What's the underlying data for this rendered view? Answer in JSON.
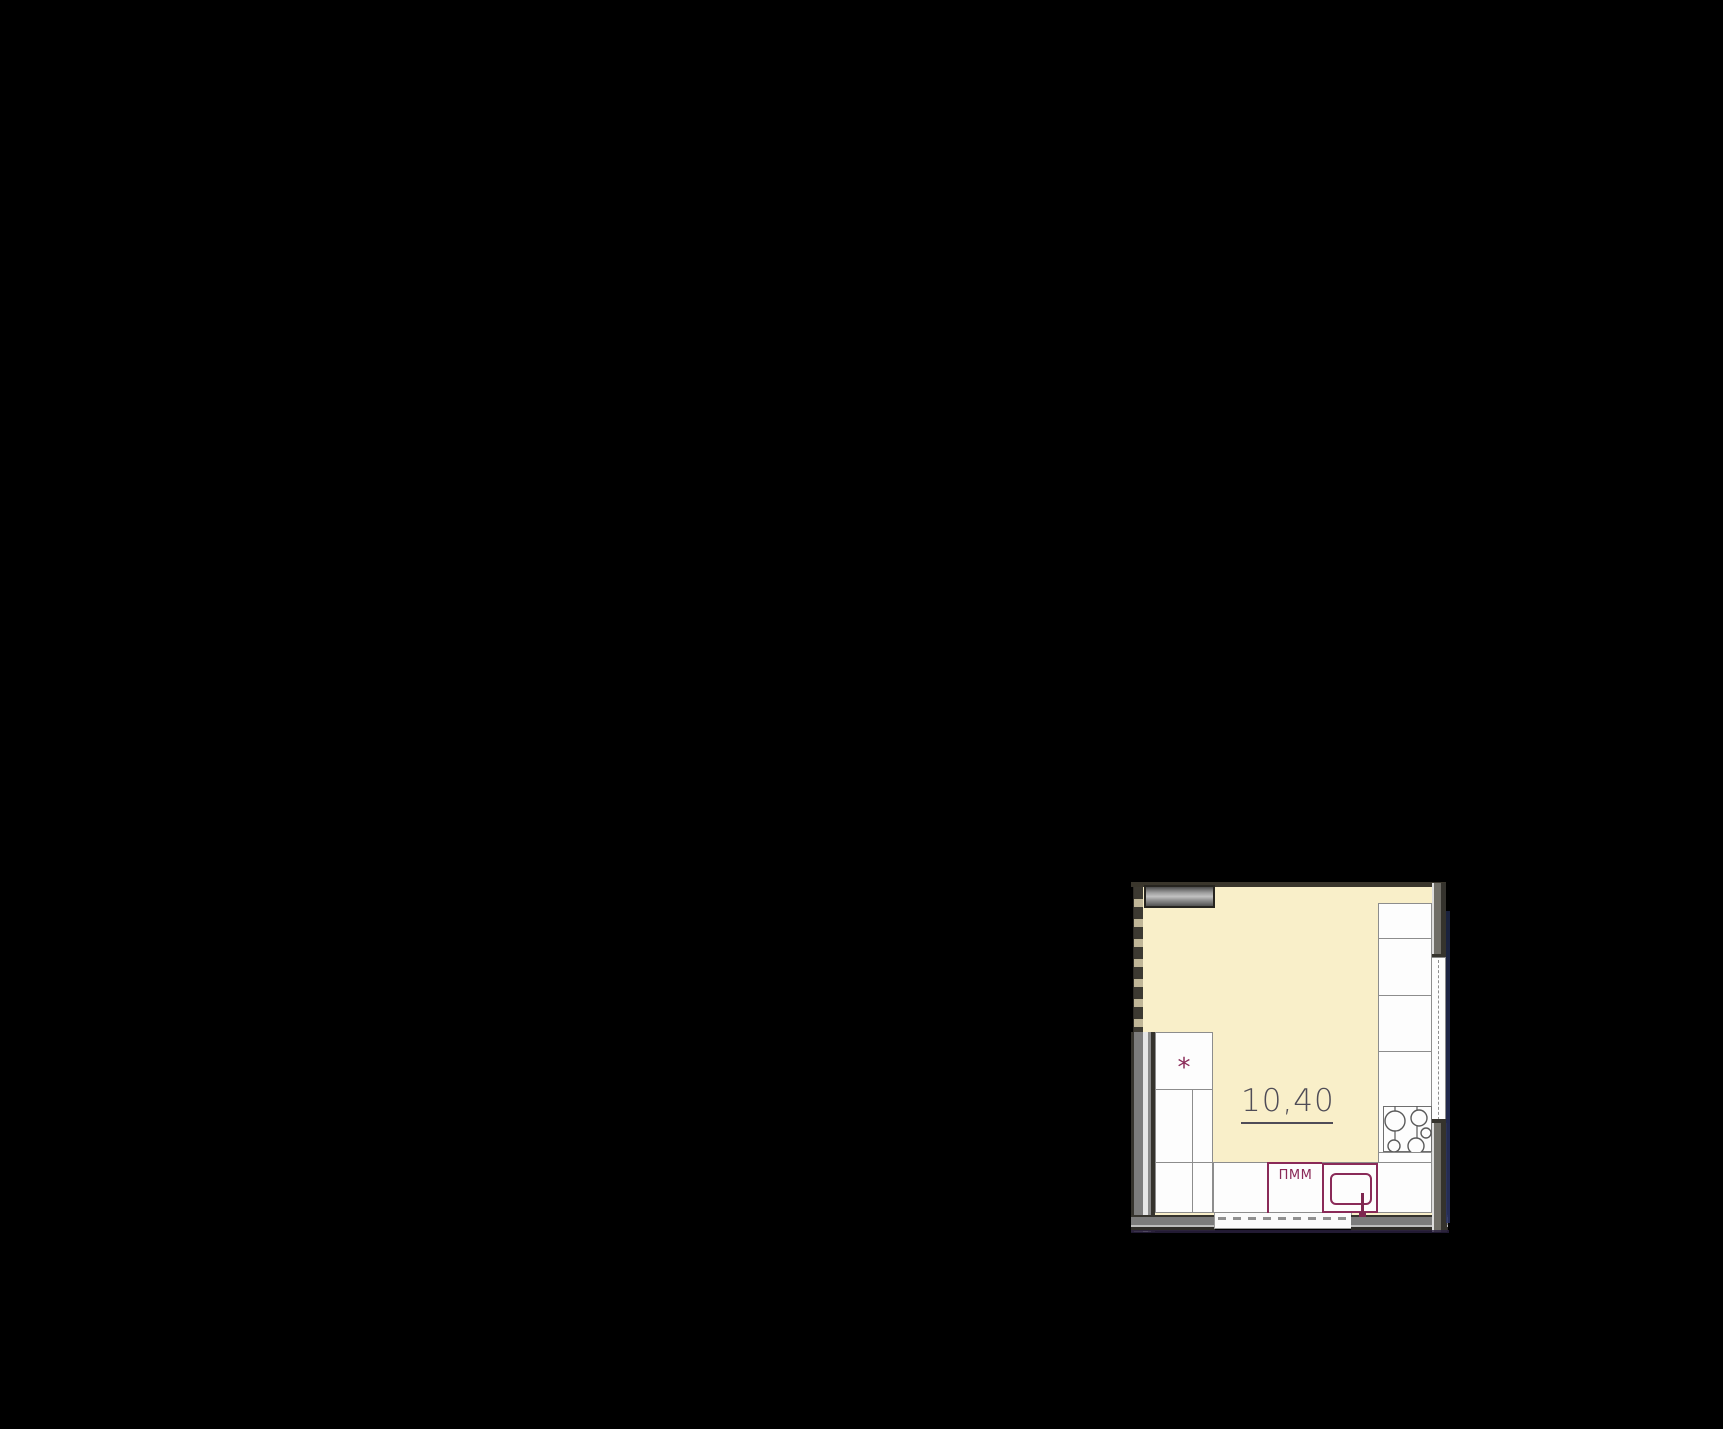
{
  "scene": {
    "background_color": "#000000",
    "description": "kitchen floor plan fragment on black background"
  },
  "plan": {
    "area_label": "10,40",
    "dishwasher_label": "ПММ",
    "fridge_marker": "*",
    "colors": {
      "room_fill": "#f9efc9",
      "wall_dark": "#35332d",
      "wall_fill": "#7c7c7c",
      "counter_fill": "#fdfdfd",
      "counter_border": "#8d8d8d",
      "fixture_accent": "#8a2a58",
      "area_text": "#4f4c57"
    },
    "fixtures": [
      "upper-cabinet",
      "fridge",
      "base-cabinets",
      "dishwasher",
      "sink",
      "cooktop",
      "window",
      "door-threshold"
    ]
  }
}
